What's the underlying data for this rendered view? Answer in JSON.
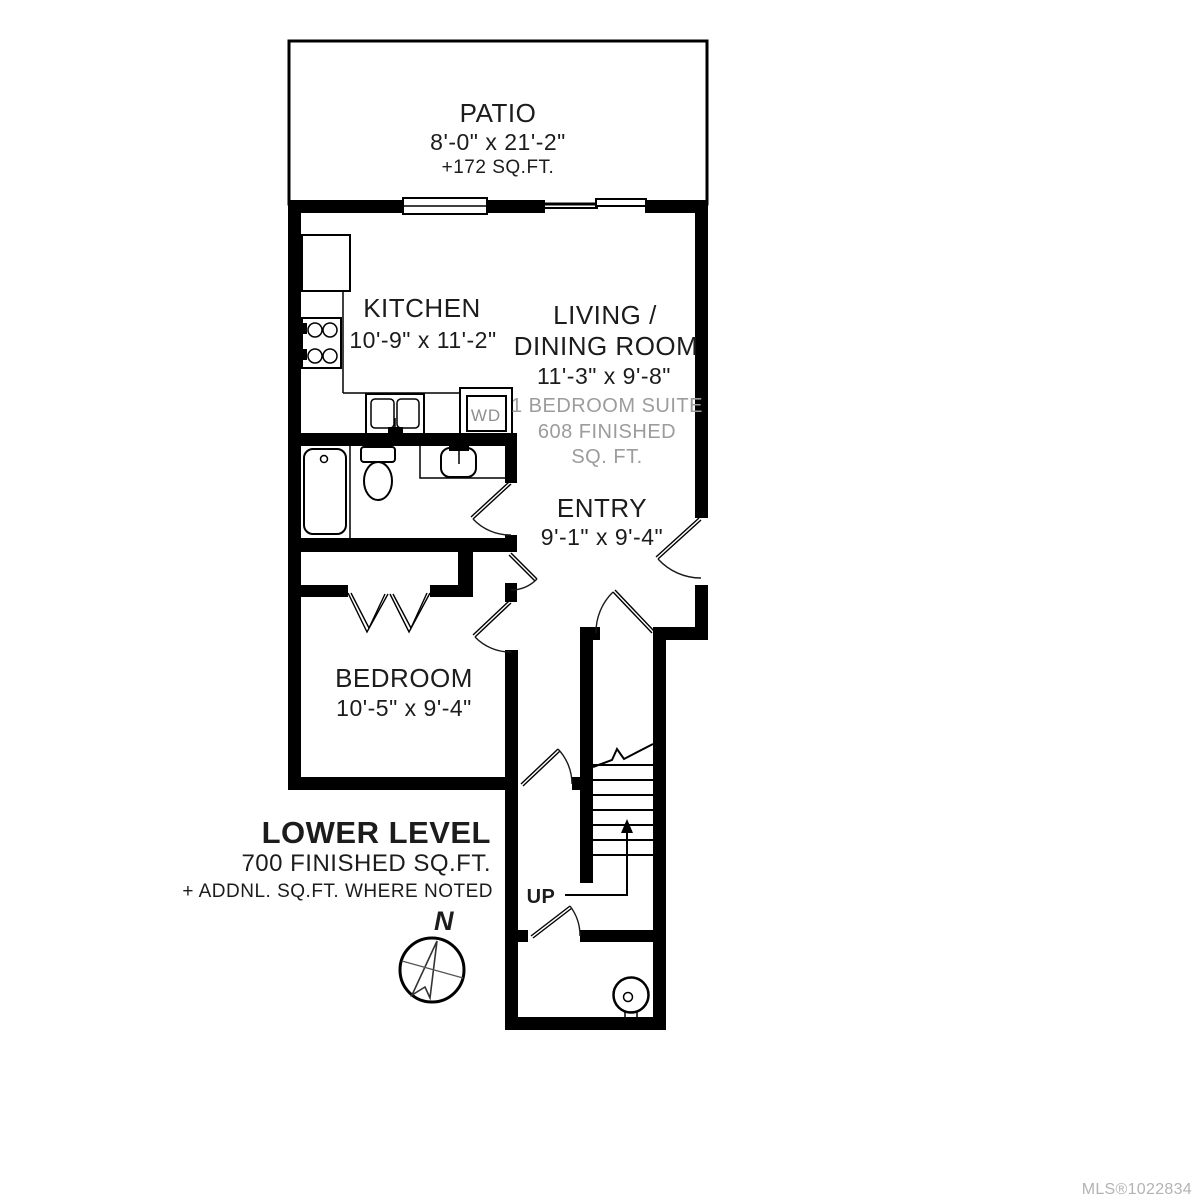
{
  "rooms": {
    "patio": {
      "name": "PATIO",
      "dims": "8'-0\" x 21'-2\"",
      "area": "+172 SQ.FT."
    },
    "kitchen": {
      "name": "KITCHEN",
      "dims": "10'-9\" x 11'-2\""
    },
    "living_dining": {
      "name_line1": "LIVING /",
      "name_line2": "DINING ROOM",
      "dims": "11'-3\" x 9'-8\"",
      "suite_note_line1": "1 BEDROOM SUITE",
      "suite_note_line2": "608 FINISHED",
      "suite_note_line3": "SQ. FT."
    },
    "entry": {
      "name": "ENTRY",
      "dims": "9'-1\" x 9'-4\""
    },
    "bedroom": {
      "name": "BEDROOM",
      "dims": "10'-5\" x 9'-4\""
    }
  },
  "stairs": {
    "direction": "UP"
  },
  "appliances": {
    "washer_dryer": "WD"
  },
  "title_block": {
    "title": "LOWER LEVEL",
    "subtitle": "700 FINISHED SQ.FT.",
    "note": "+ ADDNL. SQ.FT. WHERE NOTED"
  },
  "compass": {
    "north": "N"
  },
  "footer": {
    "mls": "MLS®1022834"
  },
  "colors": {
    "wall": "#000000",
    "text": "#1c1c1c",
    "muted": "#9c9c9c",
    "background": "#ffffff"
  }
}
